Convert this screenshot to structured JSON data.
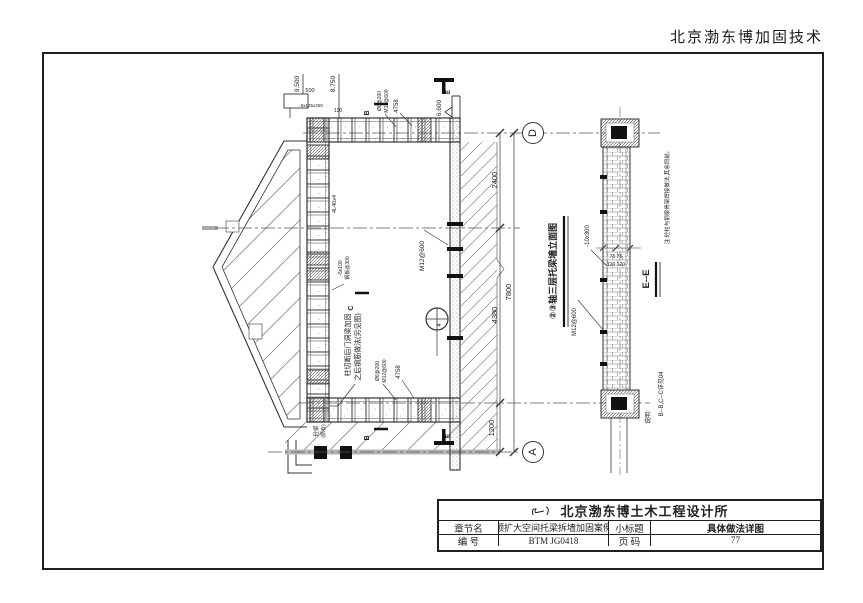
{
  "page": {
    "header_brand": "北京渤东博加固技术"
  },
  "drawing": {
    "elevation_title": "②③轴三层托梁墙立面图",
    "section_title": "E--E",
    "side_note": "注:砼柱与钢梁骨架焊接做法,其余同前。",
    "note_label": "说明:",
    "note_text": "B--B,C--C详见04",
    "axes": {
      "d": "D",
      "a": "A"
    },
    "levels": {
      "roof": "9.500",
      "parapet": "8.750",
      "beam_top": "6.600"
    },
    "dims": {
      "d1": "2400",
      "d2": "4380",
      "d_total": "7800",
      "d3": "1200",
      "d_top": "500",
      "d_130": "130",
      "w75": "75  75",
      "w120": "120  120"
    },
    "labels": {
      "bolt_plan": "M12@600",
      "bolt_section": "M12@600",
      "plate_section": "-10x300",
      "plate_top": "-5x125x250",
      "angle": "4L40x4",
      "len_top": "4758",
      "len_bot": "4758",
      "stud_a1": "Ø6@200",
      "stud_a2": "M12@600",
      "stud_b1": "Ø6@200",
      "stud_b2": "M12@600",
      "plate_mid1": "-5x100",
      "plate_mid2": "钢板@300",
      "existing1": "砼梁",
      "existing2": "(原有)",
      "anno1": "柱切断后门洞梁加固",
      "anno2": "之后钢筋做法(另见图)",
      "mark_b": "B",
      "mark_c": "C",
      "mark_e": "E",
      "detail_num": "4"
    }
  },
  "title_block": {
    "company": "北京渤东博土木工程设计所",
    "chapter_label": "章节名",
    "chapter_value": "顶扩大空间托梁拆墙加固案例",
    "subtitle_label": "小标题",
    "subtitle_value": "具体做法详图",
    "number_label": "编  号",
    "number_value": "BTM JG0418",
    "page_label": "页  码",
    "page_value": "77"
  }
}
